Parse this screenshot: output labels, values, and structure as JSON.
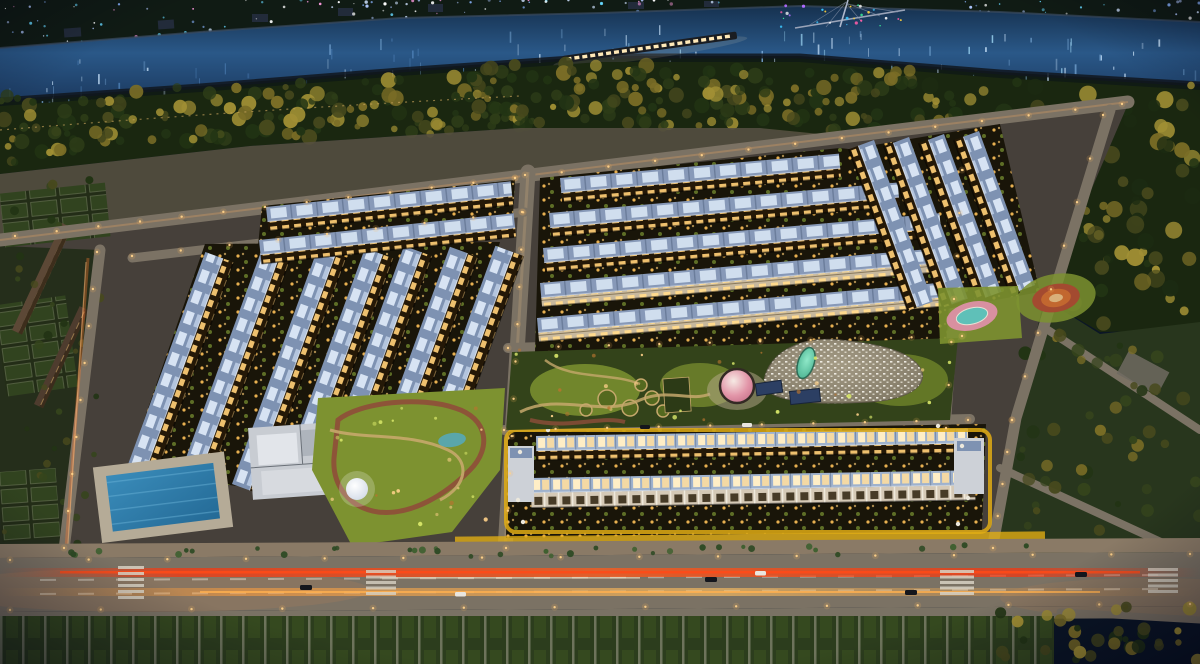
{
  "scene": {
    "palette": {
      "water_deep": "#142c4a",
      "water_mid": "#2a5888",
      "water_light": "#7fb0dd",
      "water_glint": "#cfe8ff",
      "bank_dark": "#101b14",
      "forest_base": "#1a2710",
      "tree_dark": "#223414",
      "tree_olive": "#47491d",
      "tree_gold": "#7a6d26",
      "tree_bright": "#a08f34",
      "embankment": "#55503f",
      "ground": "#46403a",
      "road": "#7b7264",
      "road_warm": "#8a7a66",
      "road_line": "#d8d2c4",
      "roof_blue": "#7e92b2",
      "roof_pale": "#9fb2cd",
      "skylight": "#dce8f6",
      "skylight_warm": "#ffeec6",
      "fac_dark": "#241807",
      "win_warm": "#eec06e",
      "win_bright": "#ffda8e",
      "fac_white": "#d5c9b6",
      "win_dark": "#473b27",
      "yellow": "#e0ac14",
      "park_dark": "#33431a",
      "park_lit": "#7d9230",
      "lawn_bright": "#a0b53e",
      "path_tan": "#c6a86c",
      "path_red": "#8f4e3a",
      "pool": "#2f7fae",
      "pool_lane": "#63aed4",
      "dome_pink": "#e295a8",
      "dome_white": "#f4f1ea",
      "blob_base": "#908873",
      "blob_dot": "#f1eee5",
      "teal": "#5ec7a6",
      "canopy_navy": "#2c3f63",
      "trail_red": "#ff3008",
      "trail_orange": "#ff9e3c",
      "light_warm": "#ffd28a",
      "plot_bg": "#232d17",
      "plot_green": "#31431f",
      "strip_green": "#2c3d1d",
      "strip_line": "#90907c"
    },
    "buildings": [
      {
        "t": "diagL",
        "x": 126,
        "y": 470,
        "l": 232
      },
      {
        "t": "diagL",
        "x": 179,
        "y": 477,
        "l": 244
      },
      {
        "t": "diagL",
        "x": 232,
        "y": 484,
        "l": 252
      },
      {
        "t": "diagL",
        "x": 285,
        "y": 468,
        "l": 234
      },
      {
        "t": "diagL",
        "x": 337,
        "y": 430,
        "l": 196
      },
      {
        "t": "diagL",
        "x": 389,
        "y": 414,
        "l": 178
      },
      {
        "t": "diagL",
        "x": 440,
        "y": 398,
        "l": 162
      },
      {
        "t": "topA",
        "x": 266,
        "y": 207,
        "l": 246
      },
      {
        "t": "topA",
        "x": 259,
        "y": 240,
        "l": 256
      },
      {
        "t": "centerA",
        "x": 560,
        "y": 178,
        "l": 280
      },
      {
        "t": "centerA",
        "x": 549,
        "y": 213,
        "l": 350
      },
      {
        "t": "centerA",
        "x": 543,
        "y": 248,
        "l": 398
      },
      {
        "t": "centerB",
        "x": 540,
        "y": 283,
        "l": 408
      },
      {
        "t": "centerB",
        "x": 537,
        "y": 318,
        "l": 412
      },
      {
        "t": "rightR",
        "x": 874,
        "y": 140,
        "l": 172
      },
      {
        "t": "rightR",
        "x": 909,
        "y": 137,
        "l": 172
      },
      {
        "t": "rightR",
        "x": 944,
        "y": 134,
        "l": 168
      },
      {
        "t": "rightR",
        "x": 979,
        "y": 131,
        "l": 164
      },
      {
        "t": "bot1",
        "x": 536,
        "y": 436,
        "l": 432
      },
      {
        "t": "bot2",
        "x": 531,
        "y": 478,
        "l": 444
      }
    ],
    "decor": {
      "seed": 20240613,
      "fields": [
        {
          "id": "g-city-lights-a",
          "shape": "dot",
          "region": [
            0,
            1,
            720,
            46
          ],
          "slope": -0.04,
          "count": 110,
          "colors": [
            "#8ab4ff",
            "#cfe2ff",
            "#66d9ff",
            "#ffffff",
            "#b0c8ff",
            "#ff9ae0"
          ],
          "rmin": 0.6,
          "rmax": 1.7,
          "omin": 0.45,
          "omax": 1
        },
        {
          "id": "g-city-lights-b",
          "shape": "dot",
          "region": [
            950,
            1,
            250,
            40
          ],
          "slope": 0,
          "count": 70,
          "colors": [
            "#8ab4ff",
            "#cfe2ff",
            "#66d9ff",
            "#ffffff",
            "#b0c8ff"
          ],
          "rmin": 0.6,
          "rmax": 1.6,
          "omin": 0.45,
          "omax": 1
        },
        {
          "id": "g-reflect-l",
          "shape": "streak",
          "region": [
            0,
            58,
            600,
            48
          ],
          "slope": -0.055,
          "count": 55,
          "colors": [
            "#7fb0dd",
            "#cfe8ff",
            "#4f82b8"
          ],
          "wmin": 0.8,
          "wmax": 1.8,
          "hmin": 3,
          "hmax": 13,
          "omin": 0.25,
          "omax": 0.8
        },
        {
          "id": "g-reflect-r",
          "shape": "streak",
          "region": [
            600,
            24,
            600,
            44
          ],
          "slope": 0.02,
          "count": 55,
          "colors": [
            "#7fb0dd",
            "#cfe8ff",
            "#9ad2f0"
          ],
          "wmin": 0.8,
          "wmax": 1.8,
          "hmin": 3,
          "hmax": 12,
          "omin": 0.3,
          "omax": 0.85
        },
        {
          "id": "g-bridge-sparkle",
          "shape": "dot",
          "region": [
            770,
            5,
            150,
            22
          ],
          "slope": 0,
          "count": 26,
          "colors": [
            "#ff5ca8",
            "#ffd23c",
            "#3cff9e",
            "#3cc8ff",
            "#b06cff",
            "#ffffff"
          ],
          "rmin": 0.7,
          "rmax": 1.6,
          "omin": 0.7,
          "omax": 1
        },
        {
          "id": "g-forest-a",
          "shape": "dot",
          "region": [
            0,
            96,
            520,
            60
          ],
          "slope": -0.05,
          "count": 150,
          "colors": [
            "#223414",
            "#47491d",
            "#7a6d26",
            "#2e3d18",
            "#a08f34"
          ],
          "rmin": 3,
          "rmax": 8,
          "omin": 0.7,
          "omax": 1
        },
        {
          "id": "g-forest-b",
          "shape": "dot",
          "region": [
            470,
            60,
            470,
            64
          ],
          "slope": 0.02,
          "count": 150,
          "colors": [
            "#223414",
            "#47491d",
            "#7a6d26",
            "#2e3d18",
            "#a08f34"
          ],
          "rmin": 3,
          "rmax": 8,
          "omin": 0.7,
          "omax": 1
        },
        {
          "id": "g-forest-c",
          "shape": "dot",
          "region": [
            920,
            82,
            280,
            244
          ],
          "slope": 0,
          "count": 140,
          "colors": [
            "#223414",
            "#47491d",
            "#7a6d26",
            "#1c2b12",
            "#a08f34"
          ],
          "rmin": 3.5,
          "rmax": 9,
          "omin": 0.7,
          "omax": 1
        },
        {
          "id": "g-right-trees",
          "shape": "dot",
          "region": [
            1020,
            330,
            180,
            226
          ],
          "slope": 0,
          "count": 48,
          "colors": [
            "#223414",
            "#47491d",
            "#7a6d26",
            "#35441c"
          ],
          "rmin": 3,
          "rmax": 7,
          "omin": 0.7,
          "omax": 1
        },
        {
          "id": "g-bottom-trees",
          "shape": "dot",
          "region": [
            990,
            606,
            210,
            56
          ],
          "slope": 0,
          "count": 34,
          "colors": [
            "#223414",
            "#7a6d26",
            "#a08f34",
            "#47491d"
          ],
          "rmin": 3,
          "rmax": 7,
          "omin": 0.8,
          "omax": 1
        },
        {
          "id": "g-palms",
          "shape": "dot",
          "region": [
            70,
            548,
            960,
            10
          ],
          "slope": -0.004,
          "count": 36,
          "colors": [
            "#2e4a24",
            "#3f6030"
          ],
          "rmin": 2,
          "rmax": 3.5,
          "omin": 0.85,
          "omax": 1
        },
        {
          "id": "g-left-field-trees",
          "shape": "dot",
          "region": [
            0,
            160,
            100,
            390
          ],
          "slope": 0,
          "count": 36,
          "colors": [
            "#223414",
            "#35441c",
            "#47491d"
          ],
          "rmin": 2.5,
          "rmax": 5,
          "omin": 0.7,
          "omax": 1
        },
        {
          "id": "g-park-dots-left",
          "shape": "dot",
          "region": [
            330,
            402,
            165,
            126
          ],
          "slope": 0,
          "count": 22,
          "colors": [
            "#ffd28a",
            "#d9e86a",
            "#b8742f"
          ],
          "rmin": 1,
          "rmax": 2.4,
          "omin": 0.5,
          "omax": 0.95
        },
        {
          "id": "g-park-dots-c",
          "shape": "dot",
          "region": [
            515,
            350,
            440,
            70
          ],
          "slope": 0,
          "count": 30,
          "colors": [
            "#ffd28a",
            "#d9e86a",
            "#b8742f"
          ],
          "rmin": 1,
          "rmax": 2.4,
          "omin": 0.5,
          "omax": 0.95
        }
      ],
      "streetlights": {
        "color": "#ffd28a",
        "halo": "#ffb860",
        "segments": [
          [
            15,
            236,
            515,
            178,
            13
          ],
          [
            515,
            178,
            1122,
            104,
            14
          ],
          [
            97,
            252,
            64,
            548,
            9
          ],
          [
            525,
            175,
            506,
            548,
            11
          ],
          [
            1103,
            115,
            1012,
            420,
            8
          ],
          [
            1012,
            420,
            993,
            548,
            5
          ],
          [
            132,
            256,
            522,
            212,
            9
          ],
          [
            508,
            348,
            962,
            336,
            10
          ],
          [
            504,
            430,
            968,
            420,
            10
          ],
          [
            10,
            560,
            1190,
            554,
            16
          ],
          [
            10,
            610,
            1190,
            604,
            14
          ],
          [
            962,
            170,
            946,
            428,
            7
          ]
        ]
      }
    }
  }
}
